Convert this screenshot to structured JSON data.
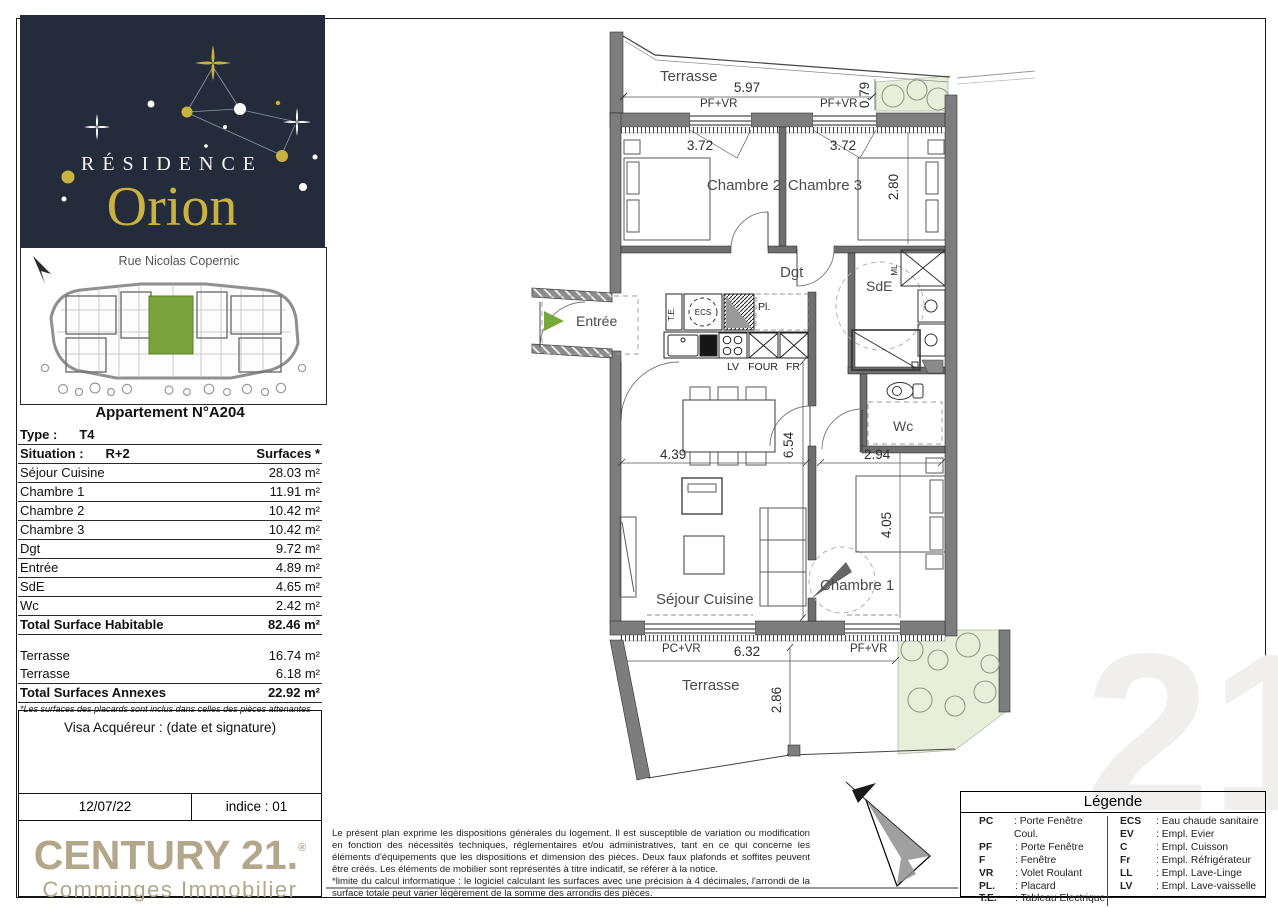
{
  "logo": {
    "residence": "RÉSIDENCE",
    "name": "Orion",
    "bg": "#242c3c",
    "gold": "#c9b23f"
  },
  "site_plan": {
    "street": "Rue Nicolas Copernic",
    "unit_color": "#7ba33d"
  },
  "apartment": {
    "title": "Appartement N°A204",
    "type_label": "Type :",
    "type_value": "T4",
    "situation_label": "Situation :",
    "situation_value": "R+2",
    "surfaces_header": "Surfaces *",
    "rooms": [
      {
        "name": "Séjour Cuisine",
        "area": "28.03 m²"
      },
      {
        "name": "Chambre 1",
        "area": "11.91 m²"
      },
      {
        "name": "Chambre 2",
        "area": "10.42 m²"
      },
      {
        "name": "Chambre 3",
        "area": "10.42 m²"
      },
      {
        "name": "Dgt",
        "area": "9.72 m²"
      },
      {
        "name": "Entrée",
        "area": "4.89 m²"
      },
      {
        "name": "SdE",
        "area": "4.65 m²"
      },
      {
        "name": "Wc",
        "area": "2.42 m²"
      }
    ],
    "total_habitable": {
      "name": "Total Surface Habitable",
      "area": "82.46 m²"
    },
    "annexes": [
      {
        "name": "Terrasse",
        "area": "16.74 m²"
      },
      {
        "name": "Terrasse",
        "area": "6.18 m²"
      }
    ],
    "total_annexes": {
      "name": "Total Surfaces Annexes",
      "area": "22.92 m²"
    },
    "footnote": "*Les surfaces des placards sont inclus dans celles des pièces attenantes"
  },
  "visa": {
    "label": "Visa Acquéreur : (date et signature)",
    "date": "12/07/22",
    "indice": "indice : 01"
  },
  "century21": {
    "brand": "CENTURY 21.",
    "registered": "®",
    "agency": "Comminges Immobilier",
    "color": "#b3a789",
    "watermark": "21"
  },
  "legal": {
    "p1": "Le présent plan exprime les dispositions générales du logement. Il est susceptible de variation ou modification en fonction des nécessités techniques, réglementaires et/ou administratives, tant en ce qui concerne les éléments d'équipements que les dispositions et dimension des pièces. Deux faux plafonds et soffites peuvent être créés. Les éléments de mobilier sont représentés à titre indicatif, se référer à la notice.",
    "p2": "*limite du calcul informatique : le logiciel calculant les surfaces avec une précision à 4 décimales, l'arrondi de la surface totale peut varier légèrement de la somme des arrondis des pièces."
  },
  "legend": {
    "title": "Légende",
    "left": [
      {
        "abbr": "PC",
        "desc": ": Porte Fenêtre Coul."
      },
      {
        "abbr": "PF",
        "desc": ": Porte Fenêtre"
      },
      {
        "abbr": "F",
        "desc": ": Fenêtre"
      },
      {
        "abbr": "VR",
        "desc": ": Volet Roulant"
      },
      {
        "abbr": "PL.",
        "desc": ": Placard"
      },
      {
        "abbr": "T.E.",
        "desc": ": Tableau Electrique"
      }
    ],
    "right": [
      {
        "abbr": "ECS",
        "desc": ": Eau chaude sanitaire"
      },
      {
        "abbr": "EV",
        "desc": ": Empl. Evier"
      },
      {
        "abbr": "C",
        "desc": ": Empl. Cuisson"
      },
      {
        "abbr": "Fr",
        "desc": ": Empl. Réfrigérateur"
      },
      {
        "abbr": "LL",
        "desc": ": Empl. Lave-Linge"
      },
      {
        "abbr": "LV",
        "desc": ": Empl. Lave-vaisselle"
      }
    ]
  },
  "plan": {
    "labels": {
      "terrasse_top": "Terrasse",
      "chambre2": "Chambre 2",
      "chambre3": "Chambre 3",
      "dgt": "Dgt",
      "sde": "SdE",
      "entree": "Entrée",
      "wc": "Wc",
      "sejour": "Séjour Cuisine",
      "chambre1": "Chambre 1",
      "terrasse_bottom": "Terrasse"
    },
    "dims": {
      "terrace_top_w": "5.97",
      "terrace_top_d": "0.79",
      "ch2_w": "3.72",
      "ch3_w": "3.72",
      "ch3_h": "2.80",
      "sejour_w": "4.39",
      "sejour_h": "6.54",
      "ch1_w": "2.94",
      "ch1_h": "4.05",
      "terrace_bottom_w": "6.32",
      "terrace_bottom_d": "2.86"
    },
    "openings": {
      "pf_vr": "PF+VR",
      "pc_vr": "PC+VR"
    },
    "equipment": {
      "te": "T.E.",
      "ecs": "ECS",
      "pl": "Pl.",
      "lv": "LV",
      "four": "FOUR",
      "fr": "FR",
      "ml": "ML"
    }
  }
}
